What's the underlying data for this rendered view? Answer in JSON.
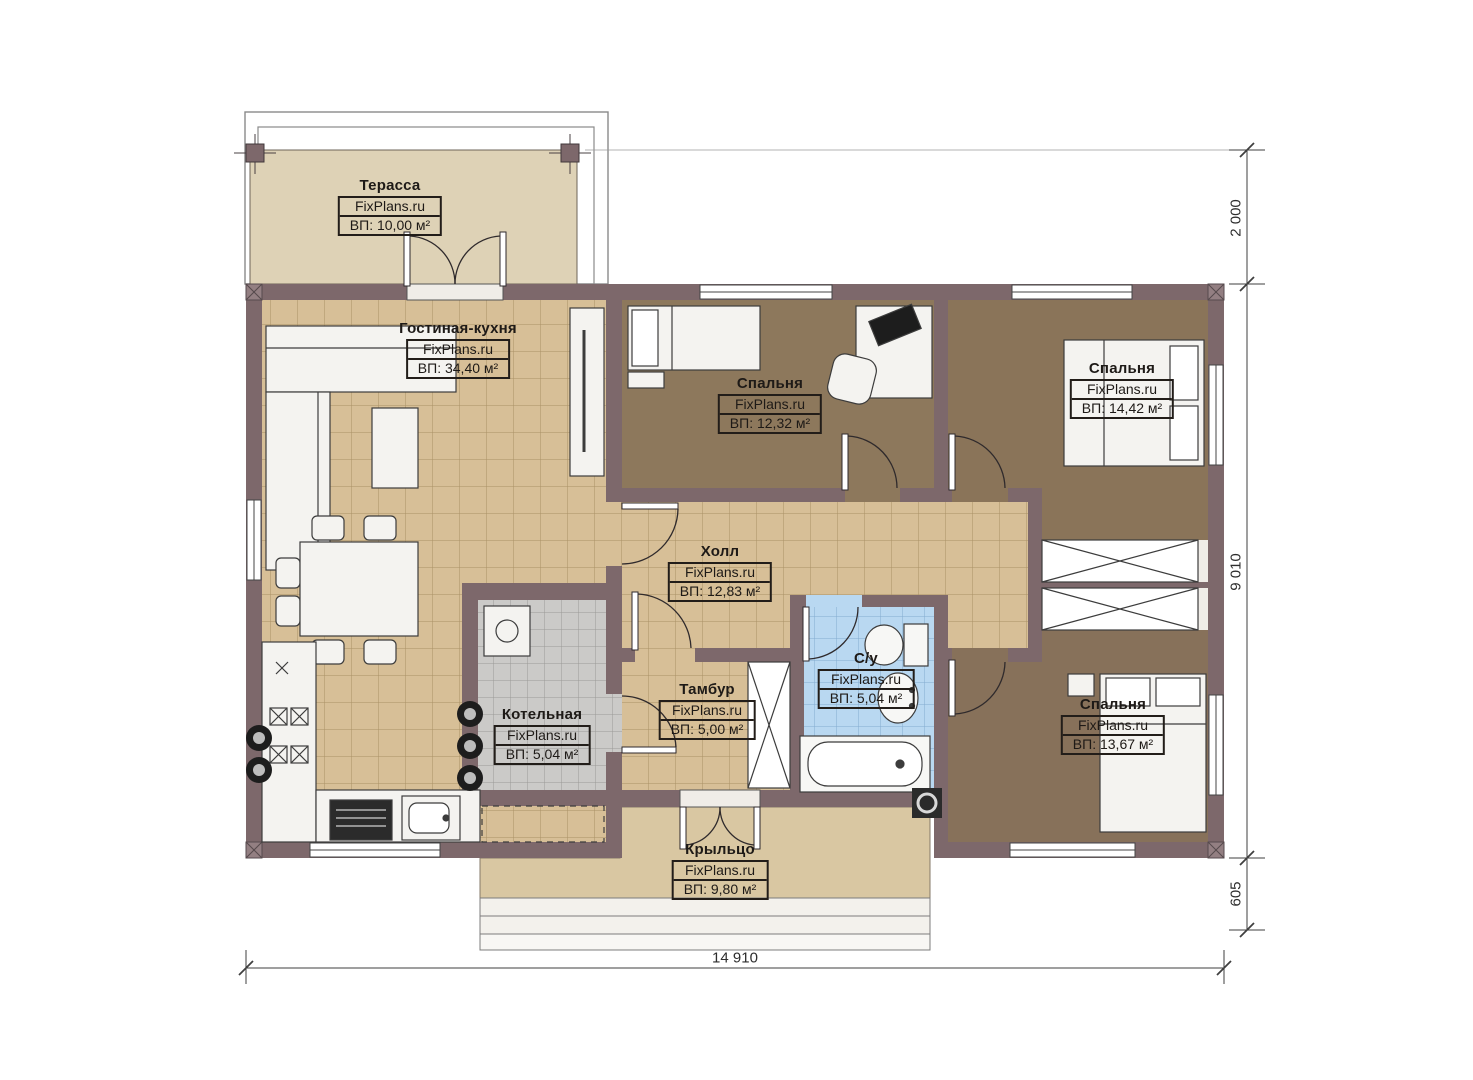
{
  "plan": {
    "brand": "FixPlans.ru",
    "rooms": [
      {
        "id": "terrace",
        "name": "Терасса",
        "area": "ВП: 10,00 м²"
      },
      {
        "id": "living-kitchen",
        "name": "Гостиная-кухня",
        "area": "ВП: 34,40 м²"
      },
      {
        "id": "bedroom-center",
        "name": "Спальня",
        "area": "ВП: 12,32 м²"
      },
      {
        "id": "bedroom-top-right",
        "name": "Спальня",
        "area": "ВП: 14,42 м²"
      },
      {
        "id": "hall",
        "name": "Холл",
        "area": "ВП: 12,83 м²"
      },
      {
        "id": "bathroom",
        "name": "С/у",
        "area": "ВП: 5,04 м²"
      },
      {
        "id": "tambour",
        "name": "Тамбур",
        "area": "ВП: 5,00 м²"
      },
      {
        "id": "boiler-room",
        "name": "Котельная",
        "area": "ВП: 5,04 м²"
      },
      {
        "id": "bedroom-bottom-right",
        "name": "Спальня",
        "area": "ВП: 13,67 м²"
      },
      {
        "id": "porch",
        "name": "Крыльцо",
        "area": "ВП: 9,80 м²"
      }
    ],
    "dimensions": {
      "terrace_depth": "2 000",
      "house_depth": "9 010",
      "porch_depth": "605",
      "house_width": "14 910"
    },
    "colors": {
      "wall": "#7d686b",
      "tile_floor": "#d7bf97",
      "bedroom_floor": "#8a7459",
      "bathroom_floor": "#b9d8f1",
      "terrace_floor": "#ded2b6",
      "porch_floor": "#d9c7a2",
      "boiler_floor": "#cbcac8"
    }
  }
}
